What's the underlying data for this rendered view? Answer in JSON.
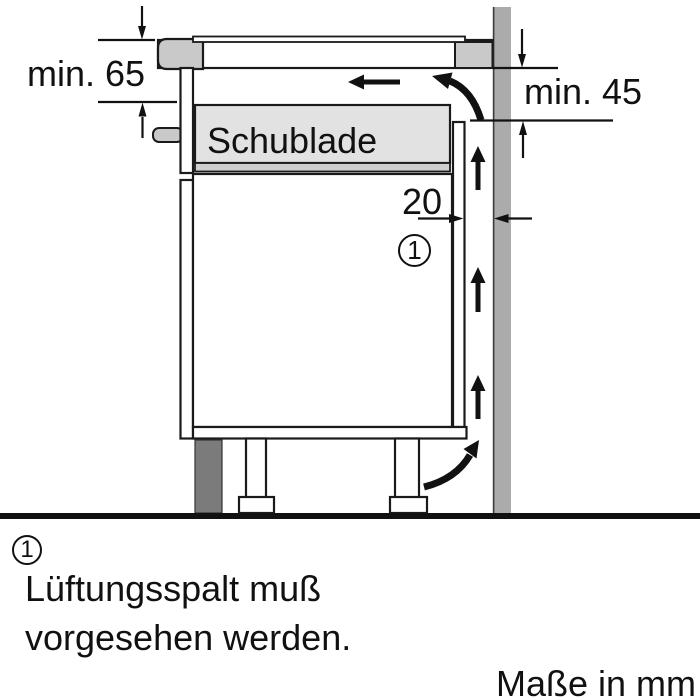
{
  "diagram": {
    "drawer_label": "Schublade",
    "dim_worktop_clearance": "min. 65",
    "dim_rear_clearance": "min. 45",
    "dim_vent_gap_width": "20",
    "callout_marker": "1"
  },
  "legend": {
    "marker": "1",
    "note_line1": "Lüftungsspalt muß",
    "note_line2": "vorgesehen werden."
  },
  "footer": {
    "units_note": "Maße in mm"
  },
  "colors": {
    "wall": "#ababab",
    "worktop_end": "#c9c9c9",
    "drawer_fill": "#e2e2e2",
    "drawer_bottom": "#cfcfcf",
    "plinth": "#7b7b7b",
    "line": "#1a1a1a"
  }
}
